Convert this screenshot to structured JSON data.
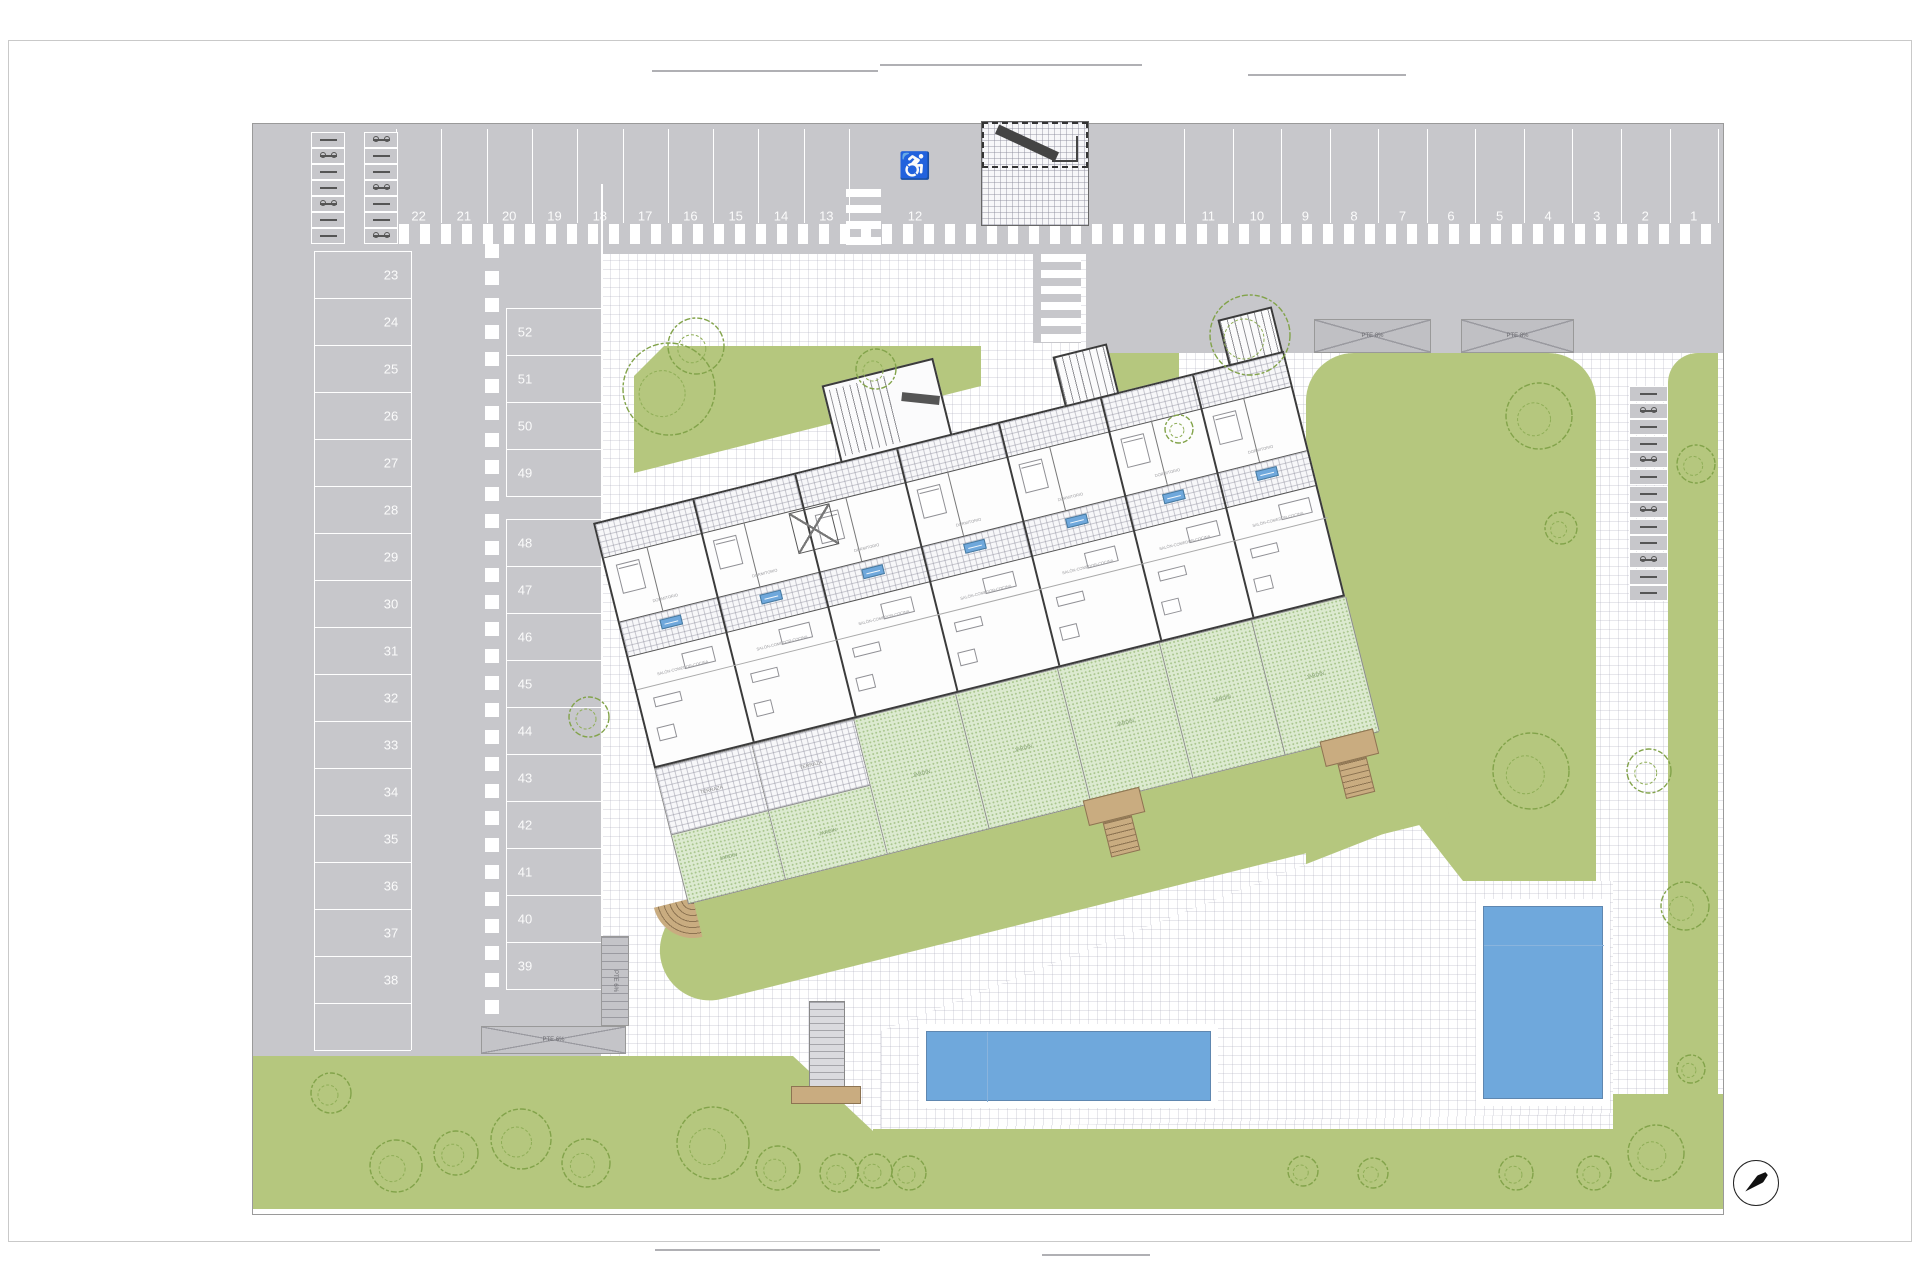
{
  "page": {
    "background": "#ffffff"
  },
  "colors": {
    "asphalt": "#c7c7cb",
    "lawn": "#b5c77e",
    "private_garden": "#dcead0",
    "pool_water": "#6fa8dc",
    "stair_tan": "#c9ac80",
    "building_wall": "#3b3b3b",
    "paving_grid": "#d9dce3",
    "unit_tag_blue": "#6fa8dc"
  },
  "icons": {
    "wheelchair": "♿",
    "north_arrow": "compass-needle"
  },
  "parking": {
    "row_top_left_numbers": [
      "22",
      "21",
      "20",
      "19",
      "18",
      "17",
      "16",
      "15",
      "14",
      "13"
    ],
    "handicap_space_number": "12",
    "row_top_right_numbers": [
      "11",
      "10",
      "9",
      "8",
      "7",
      "6",
      "5",
      "4",
      "3",
      "2",
      "1"
    ],
    "col_left_numbers": [
      "23",
      "24",
      "25",
      "26",
      "27",
      "28",
      "29",
      "30",
      "31",
      "32",
      "33",
      "34",
      "35",
      "36",
      "37",
      "38"
    ],
    "col_mid_upper_numbers": [
      "52",
      "51",
      "50",
      "49"
    ],
    "col_mid_lower_numbers": [
      "48",
      "47",
      "46",
      "45",
      "44",
      "43",
      "42",
      "41",
      "40",
      "39"
    ],
    "moto_slot_rows": 7,
    "bike_rack_slots": 13
  },
  "ramps": {
    "right_a_label": "PTE 8%",
    "right_b_label": "PTE 8%",
    "left_h_label": "PTE 6%",
    "left_v_label": "PTE 6%"
  },
  "building": {
    "unit_count": 7,
    "unit_labels": {
      "living": "SALÓN-COMEDOR-COCINA",
      "bedroom": "DORMITORIO",
      "garden": "JARDÍN",
      "terrace": "TERRAZA"
    }
  },
  "trees": [
    [
      416,
      265,
      46
    ],
    [
      443,
      222,
      28
    ],
    [
      623,
      245,
      20
    ],
    [
      997,
      211,
      40
    ],
    [
      926,
      305,
      14
    ],
    [
      1286,
      292,
      33
    ],
    [
      1308,
      404,
      16
    ],
    [
      1443,
      340,
      19
    ],
    [
      1278,
      647,
      38
    ],
    [
      1396,
      647,
      22
    ],
    [
      1432,
      782,
      24
    ],
    [
      1438,
      945,
      14
    ],
    [
      336,
      593,
      20
    ],
    [
      78,
      969,
      20
    ],
    [
      143,
      1042,
      26
    ],
    [
      203,
      1029,
      22
    ],
    [
      268,
      1015,
      30
    ],
    [
      333,
      1039,
      24
    ],
    [
      460,
      1019,
      36
    ],
    [
      525,
      1044,
      22
    ],
    [
      586,
      1049,
      19
    ],
    [
      622,
      1047,
      17
    ],
    [
      656,
      1049,
      17
    ],
    [
      1050,
      1047,
      15
    ],
    [
      1120,
      1049,
      15
    ],
    [
      1263,
      1049,
      17
    ],
    [
      1341,
      1049,
      17
    ],
    [
      1403,
      1029,
      28
    ]
  ]
}
